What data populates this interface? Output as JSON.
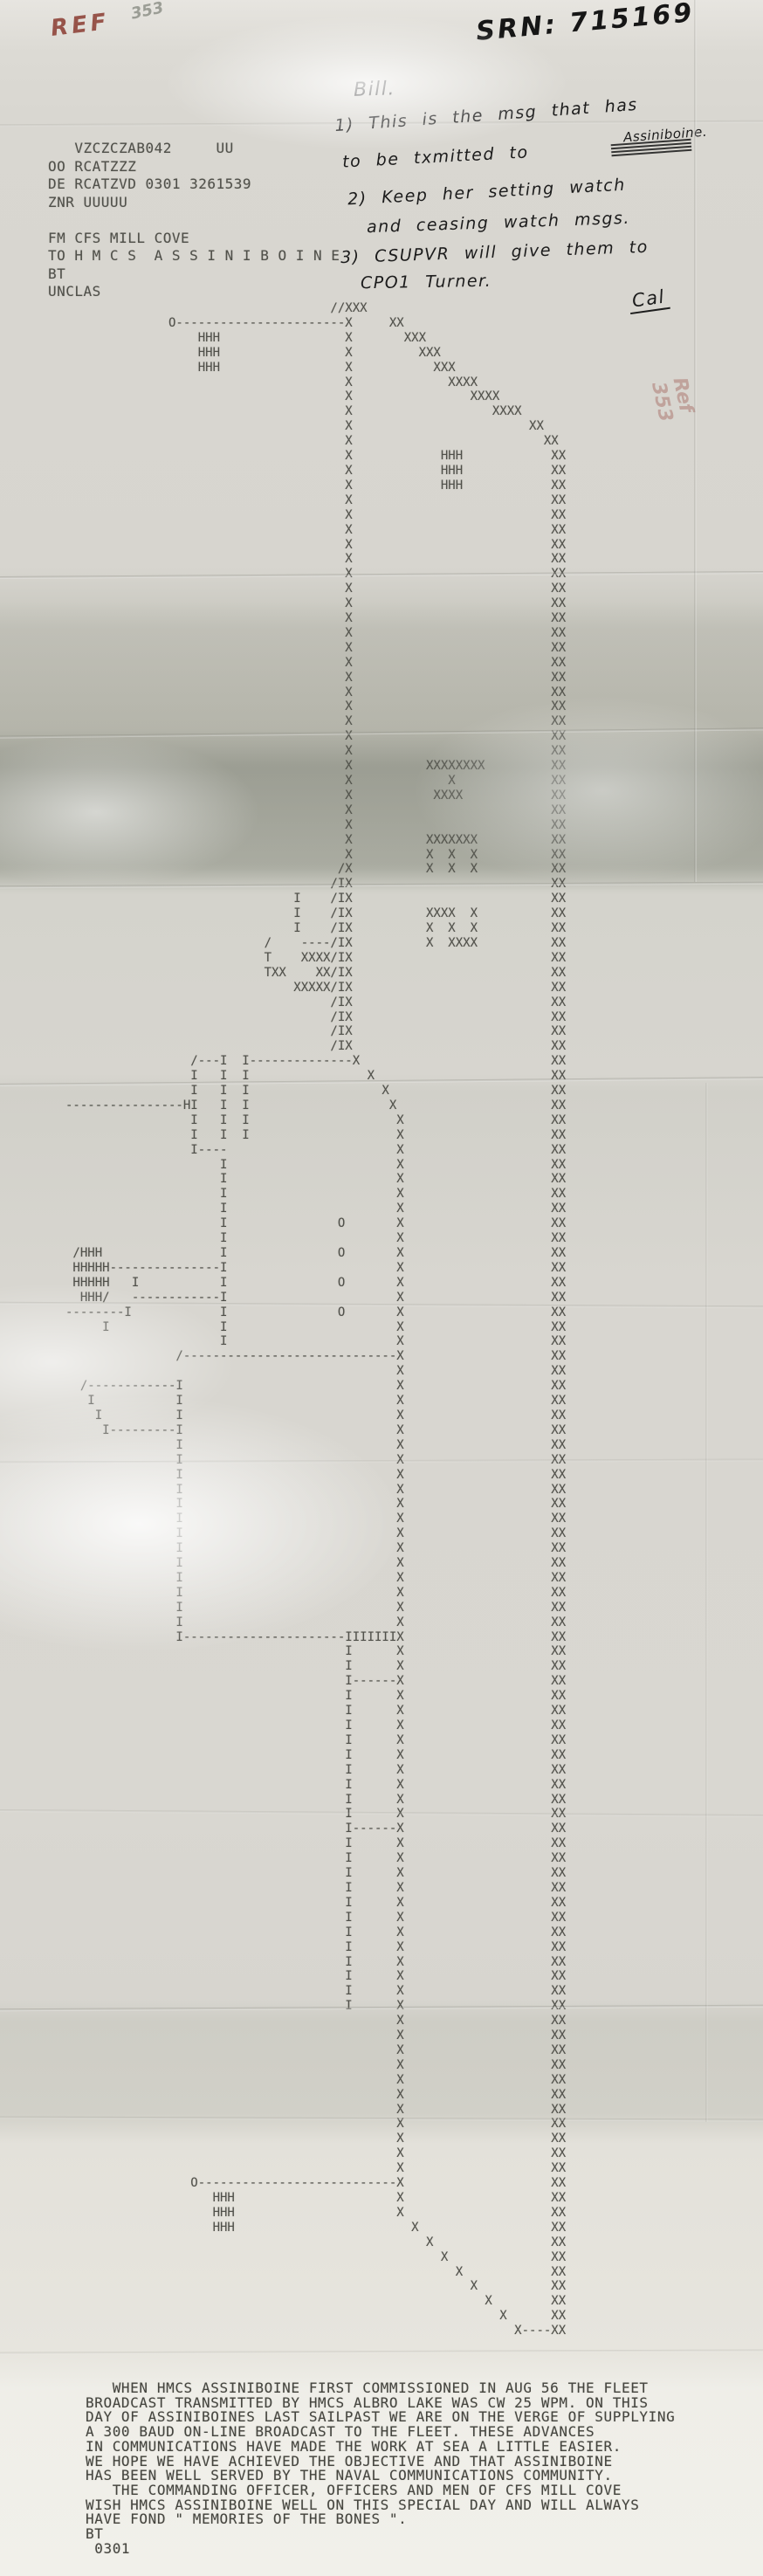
{
  "annotations": {
    "ref_label": "REF",
    "ref_number": "353",
    "srn_label": "SRN:",
    "srn_number": "715169",
    "side_note": "Ref 353",
    "note": {
      "salutation": "Bill.",
      "line1": "1) This is the msg that has",
      "line1b": "Assiniboine.",
      "line2": "to be txmitted to",
      "line3": "2) Keep her setting watch",
      "line4": "and ceasing watch msgs.",
      "line5": "3) CSUPVR will give them to",
      "line6": "CPO1 Turner.",
      "signature": "Cal"
    }
  },
  "message": {
    "header_lines": [
      "   VZCZCZAB042     UU",
      "OO RCATZZZ",
      "DE RCATZVD 0301 3261539",
      "ZNR UUUUU",
      "",
      "FM CFS MILL COVE",
      "TO H M C S  A S S I N I B O I N E",
      "BT",
      "UNCLAS"
    ],
    "ascii_art_lines": [
      "                                    //XXX",
      "              O-----------------------X     XX",
      "                  HHH                 X       XXX",
      "                  HHH                 X         XXX",
      "                  HHH                 X           XXX",
      "                                      X             XXXX",
      "                                      X                XXXX",
      "                                      X                   XXXX",
      "                                      X                        XX",
      "                                      X                          XX",
      "                                      X            HHH            XX",
      "                                      X            HHH            XX",
      "                                      X            HHH            XX",
      "                                      X                           XX",
      "                                      X                           XX",
      "                                      X                           XX",
      "                                      X                           XX",
      "                                      X                           XX",
      "                                      X                           XX",
      "                                      X                           XX",
      "                                      X                           XX",
      "                                      X                           XX",
      "                                      X                           XX",
      "                                      X                           XX",
      "                                      X                           XX",
      "                                      X                           XX",
      "                                      X                           XX",
      "                                      X                           XX",
      "                                      X                           XX",
      "                                      X                           XX",
      "                                      X                           XX",
      "                                      X          XXXXXXXX         XX",
      "                                      X             X             XX",
      "                                      X           XXXX            XX",
      "                                      X                           XX",
      "                                      X                           XX",
      "                                      X          XXXXXXX          XX",
      "                                      X          X  X  X          XX",
      "                                     /X          X  X  X          XX",
      "                                    /IX                           XX",
      "                               I    /IX                           XX",
      "                               I    /IX          XXXX  X          XX",
      "                               I    /IX          X  X  X          XX",
      "                           /    ----/IX          X  XXXX          XX",
      "                           T    XXXX/IX                           XX",
      "                           TXX    XX/IX                           XX",
      "                               XXXXX/IX                           XX",
      "                                    /IX                           XX",
      "                                    /IX                           XX",
      "                                    /IX                           XX",
      "                                    /IX                           XX",
      "                 /---I  I--------------X                          XX",
      "                 I   I  I                X                        XX",
      "                 I   I  I                  X                      XX",
      "----------------HI   I  I                   X                     XX",
      "                 I   I  I                    X                    XX",
      "                 I   I  I                    X                    XX",
      "                 I----                       X                    XX",
      "                     I                       X                    XX",
      "                     I                       X                    XX",
      "                     I                       X                    XX",
      "                     I                       X                    XX",
      "                     I               O       X                    XX",
      "                     I                       X                    XX",
      " /HHH                I               O       X                    XX",
      " HHHHH---------------I                       X                    XX",
      " HHHHH   I           I               O       X                    XX",
      "  HHH/   ------------I                       X                    XX",
      "--------I            I               O       X                    XX",
      "     I               I                       X                    XX",
      "                     I                       X                    XX",
      "               /-----------------------------X                    XX",
      "                                             X                    XX",
      "  /------------I                             X                    XX",
      "   I           I                             X                    XX",
      "    I          I                             X                    XX",
      "     I---------I                             X                    XX",
      "               I                             X                    XX",
      "               I                             X                    XX",
      "               I                             X                    XX",
      "               I                             X                    XX",
      "               I                             X                    XX",
      "               I                             X                    XX",
      "               I                             X                    XX",
      "               I                             X                    XX",
      "               I                             X                    XX",
      "               I                             X                    XX",
      "               I                             X                    XX",
      "               I                             X                    XX",
      "               I                             X                    XX",
      "               I----------------------IIIIIIIX                    XX",
      "                                      I      X                    XX",
      "                                      I      X                    XX",
      "                                      I------X                    XX",
      "                                      I      X                    XX",
      "                                      I      X                    XX",
      "                                      I      X                    XX",
      "                                      I      X                    XX",
      "                                      I      X                    XX",
      "                                      I      X                    XX",
      "                                      I      X                    XX",
      "                                      I      X                    XX",
      "                                      I      X                    XX",
      "                                      I------X                    XX",
      "                                      I      X                    XX",
      "                                      I      X                    XX",
      "                                      I      X                    XX",
      "                                      I      X                    XX",
      "                                      I      X                    XX",
      "                                      I      X                    XX",
      "                                      I      X                    XX",
      "                                      I      X                    XX",
      "                                      I      X                    XX",
      "                                      I      X                    XX",
      "                                      I      X                    XX",
      "                                      I      X                    XX",
      "                                             X                    XX",
      "                                             X                    XX",
      "                                             X                    XX",
      "                                             X                    XX",
      "                                             X                    XX",
      "                                             X                    XX",
      "                                             X                    XX",
      "                                             X                    XX",
      "                                             X                    XX",
      "                                             X                    XX",
      "                                             X                    XX",
      "                 O---------------------------X                    XX",
      "                    HHH                      X                    XX",
      "                    HHH                      X                    XX",
      "                    HHH                        X                  XX",
      "                                                 X                XX",
      "                                                   X              XX",
      "                                                     X            XX",
      "                                                       X          XX",
      "                                                         X        XX",
      "                                                           X      XX",
      "                                                             X----XX"
    ],
    "body_lines": [
      "   WHEN HMCS ASSINIBOINE FIRST COMMISSIONED IN AUG 56 THE FLEET",
      "BROADCAST TRANSMITTED BY HMCS ALBRO LAKE WAS CW 25 WPM. ON THIS",
      "DAY OF ASSINIBOINES LAST SAILPAST WE ARE ON THE VERGE OF SUPPLYING",
      "A 300 BAUD ON-LINE BROADCAST TO THE FLEET. THESE ADVANCES",
      "IN COMMUNICATIONS HAVE MADE THE WORK AT SEA A LITTLE EASIER.",
      "WE HOPE WE HAVE ACHIEVED THE OBJECTIVE AND THAT ASSINIBOINE",
      "HAS BEEN WELL SERVED BY THE NAVAL COMMUNICATIONS COMMUNITY.",
      "   THE COMMANDING OFFICER, OFFICERS AND MEN OF CFS MILL COVE",
      "WISH HMCS ASSINIBOINE WELL ON THIS SPECIAL DAY AND WILL ALWAYS",
      "HAVE FOND \" MEMORIES OF THE BONES \".",
      "BT",
      " 0301"
    ]
  },
  "colors": {
    "paper": "#d8d6d0",
    "ink": "#50504a",
    "pen": "#1c1c1c",
    "red_pen": "#8a3b30"
  }
}
